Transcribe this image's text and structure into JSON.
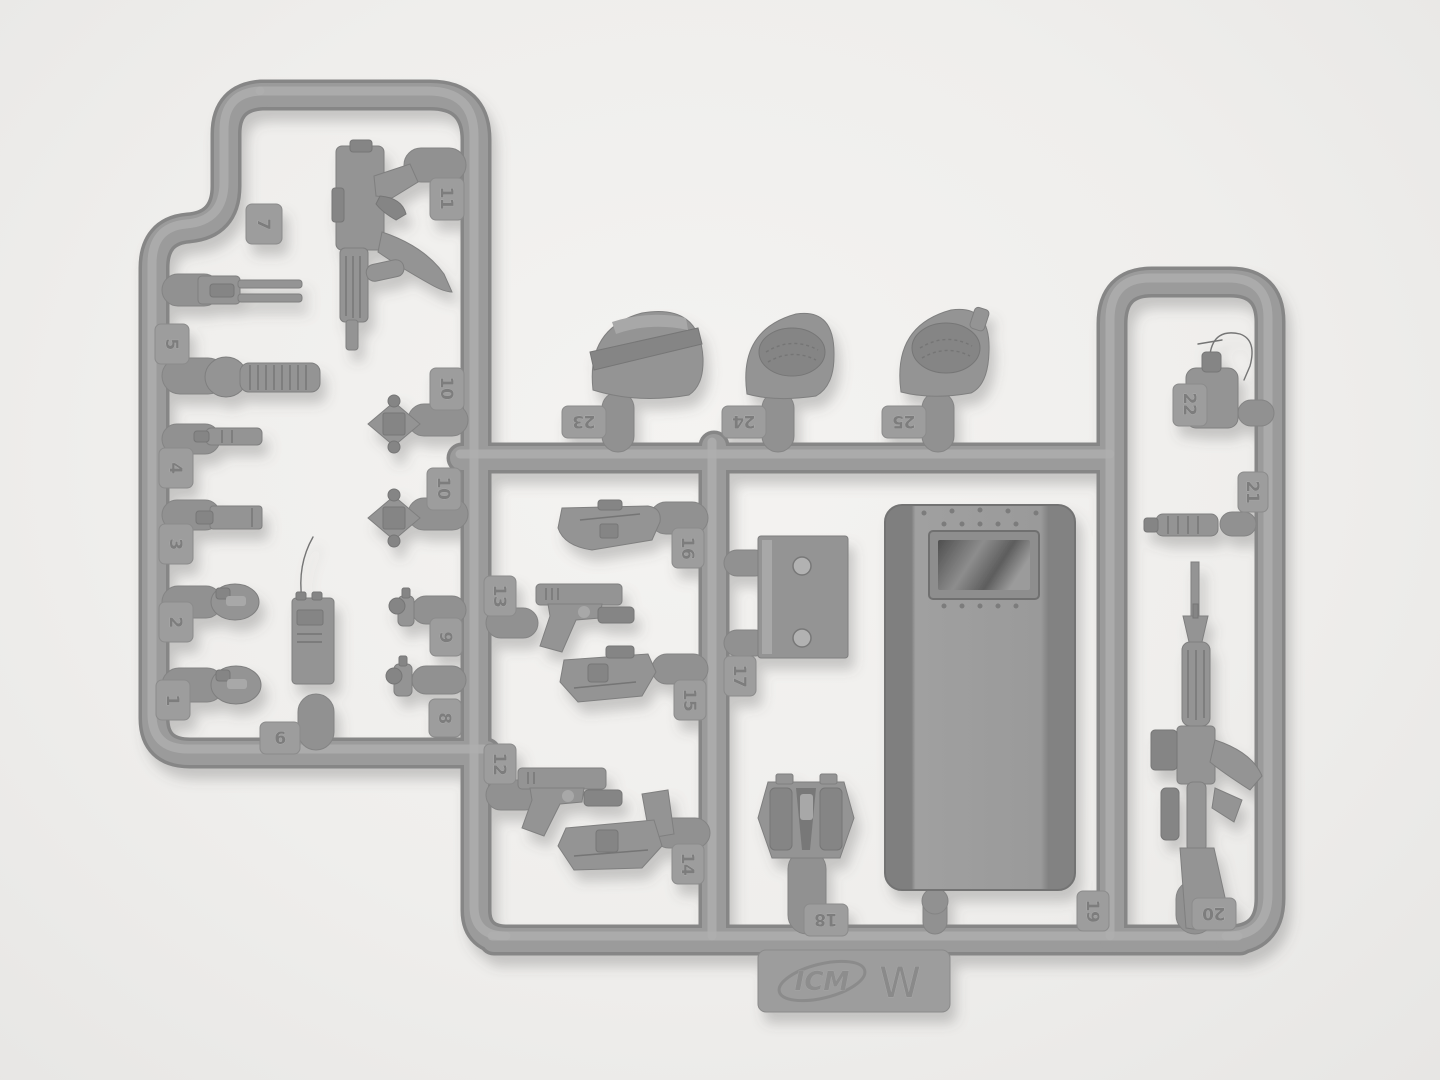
{
  "scene": {
    "type": "photograph",
    "subject": "Injection-molded plastic model kit sprue with police/SWAT equipment parts",
    "background_color": "#f1f0ee",
    "plastic_color": "#9a9a9a",
    "shadow_color": "#5a5a5a"
  },
  "branding": {
    "logo_text": "ICM",
    "sprue_letter": "W"
  },
  "tabs": {
    "t1": {
      "label": "1"
    },
    "t2": {
      "label": "2"
    },
    "t3": {
      "label": "3"
    },
    "t4": {
      "label": "4"
    },
    "t5": {
      "label": "5"
    },
    "t6": {
      "label": "6"
    },
    "t7": {
      "label": "7"
    },
    "t8": {
      "label": "8"
    },
    "t9": {
      "label": "9"
    },
    "t10a": {
      "label": "10"
    },
    "t10b": {
      "label": "10"
    },
    "t11": {
      "label": "11"
    },
    "t12": {
      "label": "12"
    },
    "t13": {
      "label": "13"
    },
    "t14": {
      "label": "14"
    },
    "t15": {
      "label": "15"
    },
    "t16": {
      "label": "16"
    },
    "t17": {
      "label": "17"
    },
    "t18": {
      "label": "18"
    },
    "t19": {
      "label": "19"
    },
    "t20": {
      "label": "20"
    },
    "t21": {
      "label": "21"
    },
    "t22": {
      "label": "22"
    },
    "t23": {
      "label": "23"
    },
    "t24": {
      "label": "24"
    },
    "t25": {
      "label": "25"
    }
  }
}
